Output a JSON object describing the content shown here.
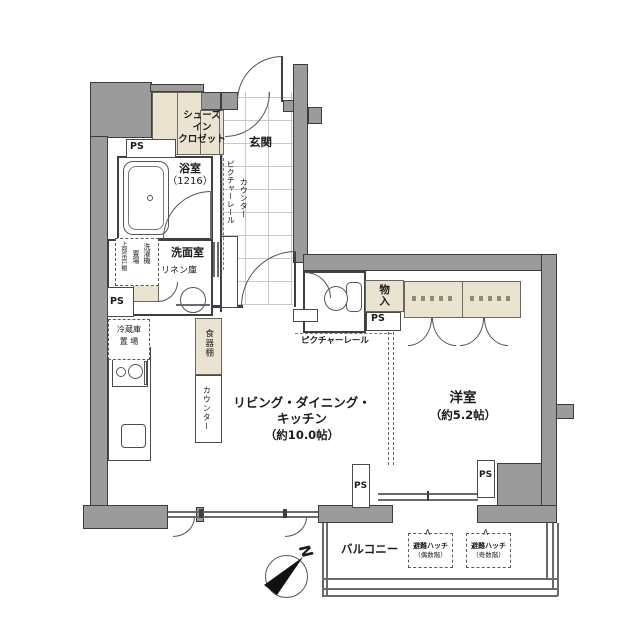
{
  "labels": {
    "ps": "PS",
    "north": "N"
  },
  "colors": {
    "wall": "#9b9b9b",
    "storage_beige": "#eae3d0",
    "outline": "#3c3c3c"
  },
  "rooms": {
    "entrance": {
      "label": "玄関"
    },
    "shoes_in_closet": {
      "lines": [
        "シューズ",
        "イン",
        "クロゼット"
      ]
    },
    "bathroom": {
      "name": "浴室",
      "size": "（1216）"
    },
    "washroom": {
      "label": "洗面室"
    },
    "linen_cabinet": {
      "label": "リネン庫"
    },
    "laundry_space": {
      "col_right": "洗濯機",
      "col_left": "置場",
      "upper_cabinet": "上部吊戸棚"
    },
    "fridge_space": {
      "lines": [
        "冷蔵庫",
        "置 場"
      ]
    },
    "dish_cabinet": {
      "label": "食器棚"
    },
    "kitchen_counter": {
      "label": "カウンター"
    },
    "hall_counter": {
      "label": "カウンター"
    },
    "hall_picture_rail": {
      "label": "ピクチャーレール"
    },
    "ldk_picture_rail": {
      "label": "ピクチャーレール"
    },
    "ldk": {
      "lines": [
        "リビング・ダイニング・",
        "キッチン",
        "（約10.0帖）"
      ]
    },
    "western_room": {
      "name": "洋室",
      "size": "（約5.2帖）"
    },
    "storage": {
      "label": "物入"
    },
    "balcony": {
      "label": "バルコニー"
    },
    "hatch_even": {
      "name": "避難ハッチ",
      "floor": "（偶数階）"
    },
    "hatch_odd": {
      "name": "避難ハッチ",
      "floor": "（奇数階）"
    }
  }
}
